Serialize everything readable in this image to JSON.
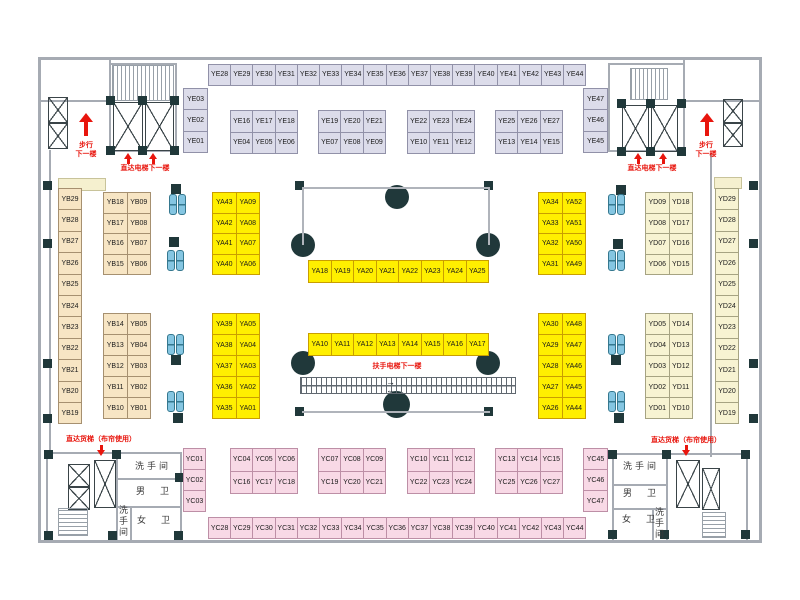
{
  "title": "market-floor-plan",
  "colors": {
    "ye_fill": "#dcdcea",
    "ye_border": "#9191a8",
    "yb_fill": "#f7e5c4",
    "yb_border": "#a69070",
    "ya_fill": "#ffef00",
    "ya_border": "#c99e00",
    "yd_fill": "#f7f3d2",
    "yd_border": "#a6a382",
    "yc_fill": "#f8d9e6",
    "yc_border": "#bd8fa6",
    "red": "#e8150d",
    "dark": "#20383a",
    "wall": "#a6abb3",
    "seat_blue": "#85c6e2"
  },
  "stall_groups": [
    {
      "id": "YE-top-row",
      "color": "ye",
      "x": 208,
      "y": 63.5,
      "cw": 22.2,
      "ch": 21,
      "rows": [
        [
          "YE28",
          "YE29",
          "YE30",
          "YE31",
          "YE32",
          "YE33",
          "YE34",
          "YE35",
          "YE36",
          "YE37",
          "YE38",
          "YE39",
          "YE40",
          "YE41",
          "YE42",
          "YE43",
          "YE44"
        ]
      ]
    },
    {
      "id": "YE-left-col",
      "color": "ye",
      "x": 183,
      "y": 88,
      "cw": 24,
      "ch": 21.4,
      "rows": [
        [
          "YE03"
        ],
        [
          "YE02"
        ],
        [
          "YE01"
        ]
      ]
    },
    {
      "id": "YE-right-col",
      "color": "ye",
      "x": 583,
      "y": 88,
      "cw": 24,
      "ch": 21.4,
      "rows": [
        [
          "YE47"
        ],
        [
          "YE46"
        ],
        [
          "YE45"
        ]
      ]
    },
    {
      "id": "YE-group1",
      "color": "ye",
      "x": 230,
      "y": 110,
      "cw": 22.3,
      "ch": 21.5,
      "rows": [
        [
          "YE16",
          "YE17",
          "YE18"
        ],
        [
          "YE04",
          "YE05",
          "YE06"
        ]
      ]
    },
    {
      "id": "YE-group2",
      "color": "ye",
      "x": 318,
      "y": 110,
      "cw": 22.3,
      "ch": 21.5,
      "rows": [
        [
          "YE19",
          "YE20",
          "YE21"
        ],
        [
          "YE07",
          "YE08",
          "YE09"
        ]
      ]
    },
    {
      "id": "YE-group3",
      "color": "ye",
      "x": 407,
      "y": 110,
      "cw": 22.3,
      "ch": 21.5,
      "rows": [
        [
          "YE22",
          "YE23",
          "YE24"
        ],
        [
          "YE10",
          "YE11",
          "YE12"
        ]
      ]
    },
    {
      "id": "YE-group4",
      "color": "ye",
      "x": 495,
      "y": 110,
      "cw": 22.3,
      "ch": 21.5,
      "rows": [
        [
          "YE25",
          "YE26",
          "YE27"
        ],
        [
          "YE13",
          "YE14",
          "YE15"
        ]
      ]
    },
    {
      "id": "YB-left-col",
      "color": "yb",
      "x": 58,
      "y": 188,
      "cw": 23,
      "ch": 21.4,
      "rows": [
        [
          "YB29"
        ],
        [
          "YB28"
        ],
        [
          "YB27"
        ],
        [
          "YB26"
        ],
        [
          "YB25"
        ],
        [
          "YB24"
        ],
        [
          "YB23"
        ],
        [
          "YB22"
        ],
        [
          "YB21"
        ],
        [
          "YB20"
        ],
        [
          "YB19"
        ]
      ]
    },
    {
      "id": "YB-block-top",
      "color": "yb",
      "x": 103,
      "y": 192,
      "cw": 23.5,
      "ch": 20.5,
      "rows": [
        [
          "YB18",
          "YB09"
        ],
        [
          "YB17",
          "YB08"
        ],
        [
          "YB16",
          "YB07"
        ],
        [
          "YB15",
          "YB06"
        ]
      ]
    },
    {
      "id": "YB-block-bottom",
      "color": "yb",
      "x": 103,
      "y": 313,
      "cw": 23.5,
      "ch": 21,
      "rows": [
        [
          "YB14",
          "YB05"
        ],
        [
          "YB13",
          "YB04"
        ],
        [
          "YB12",
          "YB03"
        ],
        [
          "YB11",
          "YB02"
        ],
        [
          "YB10",
          "YB01"
        ]
      ]
    },
    {
      "id": "YA-left-top",
      "color": "ya",
      "x": 212,
      "y": 192,
      "cw": 23.5,
      "ch": 20.5,
      "rows": [
        [
          "YA43",
          "YA09"
        ],
        [
          "YA42",
          "YA08"
        ],
        [
          "YA41",
          "YA07"
        ],
        [
          "YA40",
          "YA06"
        ]
      ]
    },
    {
      "id": "YA-left-bottom",
      "color": "ya",
      "x": 212,
      "y": 313,
      "cw": 23.5,
      "ch": 21,
      "rows": [
        [
          "YA39",
          "YA05"
        ],
        [
          "YA38",
          "YA04"
        ],
        [
          "YA37",
          "YA03"
        ],
        [
          "YA36",
          "YA02"
        ],
        [
          "YA35",
          "YA01"
        ]
      ]
    },
    {
      "id": "YA-mid-top",
      "color": "ya",
      "x": 308,
      "y": 260,
      "cw": 22.5,
      "ch": 22,
      "rows": [
        [
          "YA18",
          "YA19",
          "YA20",
          "YA21",
          "YA22",
          "YA23",
          "YA24",
          "YA25"
        ]
      ]
    },
    {
      "id": "YA-mid-bottom",
      "color": "ya",
      "x": 308,
      "y": 333,
      "cw": 22.5,
      "ch": 22,
      "rows": [
        [
          "YA10",
          "YA11",
          "YA12",
          "YA13",
          "YA14",
          "YA15",
          "YA16",
          "YA17"
        ]
      ]
    },
    {
      "id": "YA-right-top",
      "color": "ya",
      "x": 538,
      "y": 192,
      "cw": 23.5,
      "ch": 20.5,
      "rows": [
        [
          "YA34",
          "YA52"
        ],
        [
          "YA33",
          "YA51"
        ],
        [
          "YA32",
          "YA50"
        ],
        [
          "YA31",
          "YA49"
        ]
      ]
    },
    {
      "id": "YA-right-bottom",
      "color": "ya",
      "x": 538,
      "y": 313,
      "cw": 23.5,
      "ch": 21,
      "rows": [
        [
          "YA30",
          "YA48"
        ],
        [
          "YA29",
          "YA47"
        ],
        [
          "YA28",
          "YA46"
        ],
        [
          "YA27",
          "YA45"
        ],
        [
          "YA26",
          "YA44"
        ]
      ]
    },
    {
      "id": "YD-block-top",
      "color": "yd",
      "x": 645,
      "y": 192,
      "cw": 23.5,
      "ch": 20.5,
      "rows": [
        [
          "YD09",
          "YD18"
        ],
        [
          "YD08",
          "YD17"
        ],
        [
          "YD07",
          "YD16"
        ],
        [
          "YD06",
          "YD15"
        ]
      ]
    },
    {
      "id": "YD-block-bottom",
      "color": "yd",
      "x": 645,
      "y": 313,
      "cw": 23.5,
      "ch": 21,
      "rows": [
        [
          "YD05",
          "YD14"
        ],
        [
          "YD04",
          "YD13"
        ],
        [
          "YD03",
          "YD12"
        ],
        [
          "YD02",
          "YD11"
        ],
        [
          "YD01",
          "YD10"
        ]
      ]
    },
    {
      "id": "YD-right-col",
      "color": "yd",
      "x": 715,
      "y": 188,
      "cw": 23,
      "ch": 21.4,
      "rows": [
        [
          "YD29"
        ],
        [
          "YD28"
        ],
        [
          "YD27"
        ],
        [
          "YD26"
        ],
        [
          "YD25"
        ],
        [
          "YD24"
        ],
        [
          "YD23"
        ],
        [
          "YD22"
        ],
        [
          "YD21"
        ],
        [
          "YD20"
        ],
        [
          "YD19"
        ]
      ]
    },
    {
      "id": "YC-left-col",
      "color": "yc",
      "x": 183,
      "y": 448,
      "cw": 22,
      "ch": 21,
      "rows": [
        [
          "YC01"
        ],
        [
          "YC02"
        ],
        [
          "YC03"
        ]
      ]
    },
    {
      "id": "YC-group1",
      "color": "yc",
      "x": 230,
      "y": 448,
      "cw": 22.3,
      "ch": 22.5,
      "rows": [
        [
          "YC04",
          "YC05",
          "YC06"
        ],
        [
          "YC16",
          "YC17",
          "YC18"
        ]
      ]
    },
    {
      "id": "YC-group2",
      "color": "yc",
      "x": 318,
      "y": 448,
      "cw": 22.3,
      "ch": 22.5,
      "rows": [
        [
          "YC07",
          "YC08",
          "YC09"
        ],
        [
          "YC19",
          "YC20",
          "YC21"
        ]
      ]
    },
    {
      "id": "YC-group3",
      "color": "yc",
      "x": 407,
      "y": 448,
      "cw": 22.3,
      "ch": 22.5,
      "rows": [
        [
          "YC10",
          "YC11",
          "YC12"
        ],
        [
          "YC22",
          "YC23",
          "YC24"
        ]
      ]
    },
    {
      "id": "YC-group4",
      "color": "yc",
      "x": 495,
      "y": 448,
      "cw": 22.3,
      "ch": 22.5,
      "rows": [
        [
          "YC13",
          "YC14",
          "YC15"
        ],
        [
          "YC25",
          "YC26",
          "YC27"
        ]
      ]
    },
    {
      "id": "YC-right-col",
      "color": "yc",
      "x": 583,
      "y": 448,
      "cw": 24,
      "ch": 21,
      "rows": [
        [
          "YC45"
        ],
        [
          "YC46"
        ],
        [
          "YC47"
        ]
      ]
    },
    {
      "id": "YC-bottom-row",
      "color": "yc",
      "x": 208,
      "y": 517,
      "cw": 22.2,
      "ch": 21,
      "rows": [
        [
          "YC28",
          "YC29",
          "YC30",
          "YC31",
          "YC32",
          "YC33",
          "YC34",
          "YC35",
          "YC36",
          "YC37",
          "YC38",
          "YC39",
          "YC40",
          "YC41",
          "YC42",
          "YC43",
          "YC44"
        ]
      ]
    }
  ],
  "annotations": [
    {
      "name": "walk-down-note",
      "text": "步行\n下一楼",
      "x": 66,
      "y": 142,
      "w": 40
    },
    {
      "name": "walk-down-note",
      "text": "步行\n下一楼",
      "x": 686,
      "y": 142,
      "w": 40
    },
    {
      "name": "direct-elevator-note",
      "text": "直达电梯下一楼",
      "x": 105,
      "y": 165,
      "w": 80
    },
    {
      "name": "direct-elevator-note",
      "text": "直达电梯下一楼",
      "x": 612,
      "y": 165,
      "w": 80
    },
    {
      "name": "escalator-note",
      "text": "扶手电梯下一楼",
      "x": 352,
      "y": 363,
      "w": 90
    },
    {
      "name": "freight-elevator-note",
      "text": "直达货梯（布帘使用）",
      "x": 53,
      "y": 436,
      "w": 96
    },
    {
      "name": "freight-elevator-note",
      "text": "直达货梯（布帘使用）",
      "x": 638,
      "y": 437,
      "w": 96
    }
  ],
  "rooms": [
    {
      "name": "restroom-label",
      "text": "洗手间",
      "x": 128,
      "y": 462,
      "w": 50,
      "vert": false
    },
    {
      "name": "mens-room-label",
      "text": "男　卫",
      "x": 130,
      "y": 487,
      "w": 48,
      "vert": false
    },
    {
      "name": "womens-room-label",
      "text": "女　卫",
      "x": 132,
      "y": 516,
      "w": 46,
      "vert": false
    },
    {
      "name": "restroom-label",
      "text": "洗手间",
      "x": 118,
      "y": 505,
      "vert": true
    },
    {
      "name": "restroom-label",
      "text": "洗手间",
      "x": 616,
      "y": 462,
      "w": 50,
      "vert": false
    },
    {
      "name": "mens-room-label",
      "text": "男　卫",
      "x": 618,
      "y": 489,
      "w": 46,
      "vert": false
    },
    {
      "name": "womens-room-label",
      "text": "女　卫",
      "x": 617,
      "y": 515,
      "w": 46,
      "vert": false
    },
    {
      "name": "restroom-label",
      "text": "洗手间",
      "x": 654,
      "y": 507,
      "vert": true
    }
  ],
  "arrows": [
    {
      "name": "walk-up-arrow",
      "kind": "up",
      "x": 79,
      "y": 113
    },
    {
      "name": "walk-up-arrow",
      "kind": "up",
      "x": 700,
      "y": 113
    },
    {
      "name": "elevator-up-arrow",
      "kind": "up-small",
      "x": 124,
      "y": 153
    },
    {
      "name": "elevator-up-arrow",
      "kind": "up-small",
      "x": 149,
      "y": 153
    },
    {
      "name": "elevator-up-arrow",
      "kind": "up-small",
      "x": 634,
      "y": 153
    },
    {
      "name": "elevator-up-arrow",
      "kind": "up-small",
      "x": 659,
      "y": 153
    },
    {
      "name": "freight-down-arrow",
      "kind": "down-small",
      "x": 97,
      "y": 445
    },
    {
      "name": "freight-down-arrow",
      "kind": "down-small",
      "x": 682,
      "y": 445
    }
  ],
  "escalator_direction_arrows": [
    "→",
    "←"
  ]
}
